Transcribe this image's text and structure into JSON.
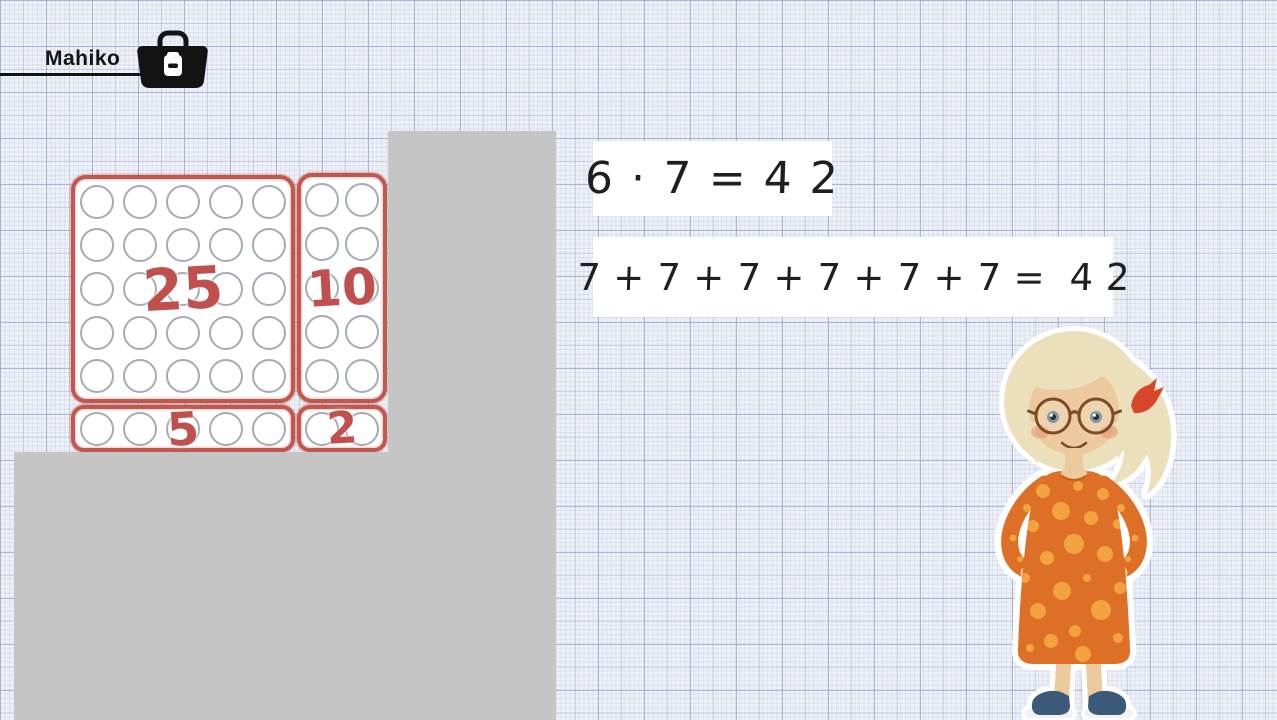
{
  "header": {
    "brand": "Mahiko",
    "toolbox_icon": "toolbox-icon"
  },
  "dot_field": {
    "description": "42 counting dots split into labelled part-fields",
    "blocks": [
      {
        "id": "block-25",
        "label": "25",
        "rows": 5,
        "cols": 5,
        "dots": 25
      },
      {
        "id": "block-10",
        "label": "10",
        "rows": 5,
        "cols": 2,
        "dots": 10
      },
      {
        "id": "block-5",
        "label": "5",
        "rows": 1,
        "cols": 5,
        "dots": 5
      },
      {
        "id": "block-2",
        "label": "2",
        "rows": 1,
        "cols": 2,
        "dots": 2
      }
    ],
    "total_dots": 42
  },
  "equations": {
    "line1": "6 · 7 = 4 2",
    "line2": "7 + 7 + 7 + 7 + 7 + 7 =  4 2"
  },
  "character": {
    "description": "Blonde girl sticker with round glasses, side ponytail with red tie, orange polka-dot dress, dark blue sneakers"
  },
  "colors": {
    "paper": "#eef0f6",
    "cover_gray": "#c5c5c6",
    "block_border_red": "#c2574f",
    "label_red": "#c0504d",
    "dot_outline_gray": "#a6abb3",
    "ink_black": "#1f1f1f",
    "dress_orange": "#dd7026",
    "dress_dot_orange": "#f2a23e",
    "hair_blonde": "#ece0bc",
    "skin": "#ecca9e",
    "shoe_navy": "#3c5a78",
    "hair_tie_red": "#d9472b",
    "glasses_brown": "#7b4a26"
  }
}
